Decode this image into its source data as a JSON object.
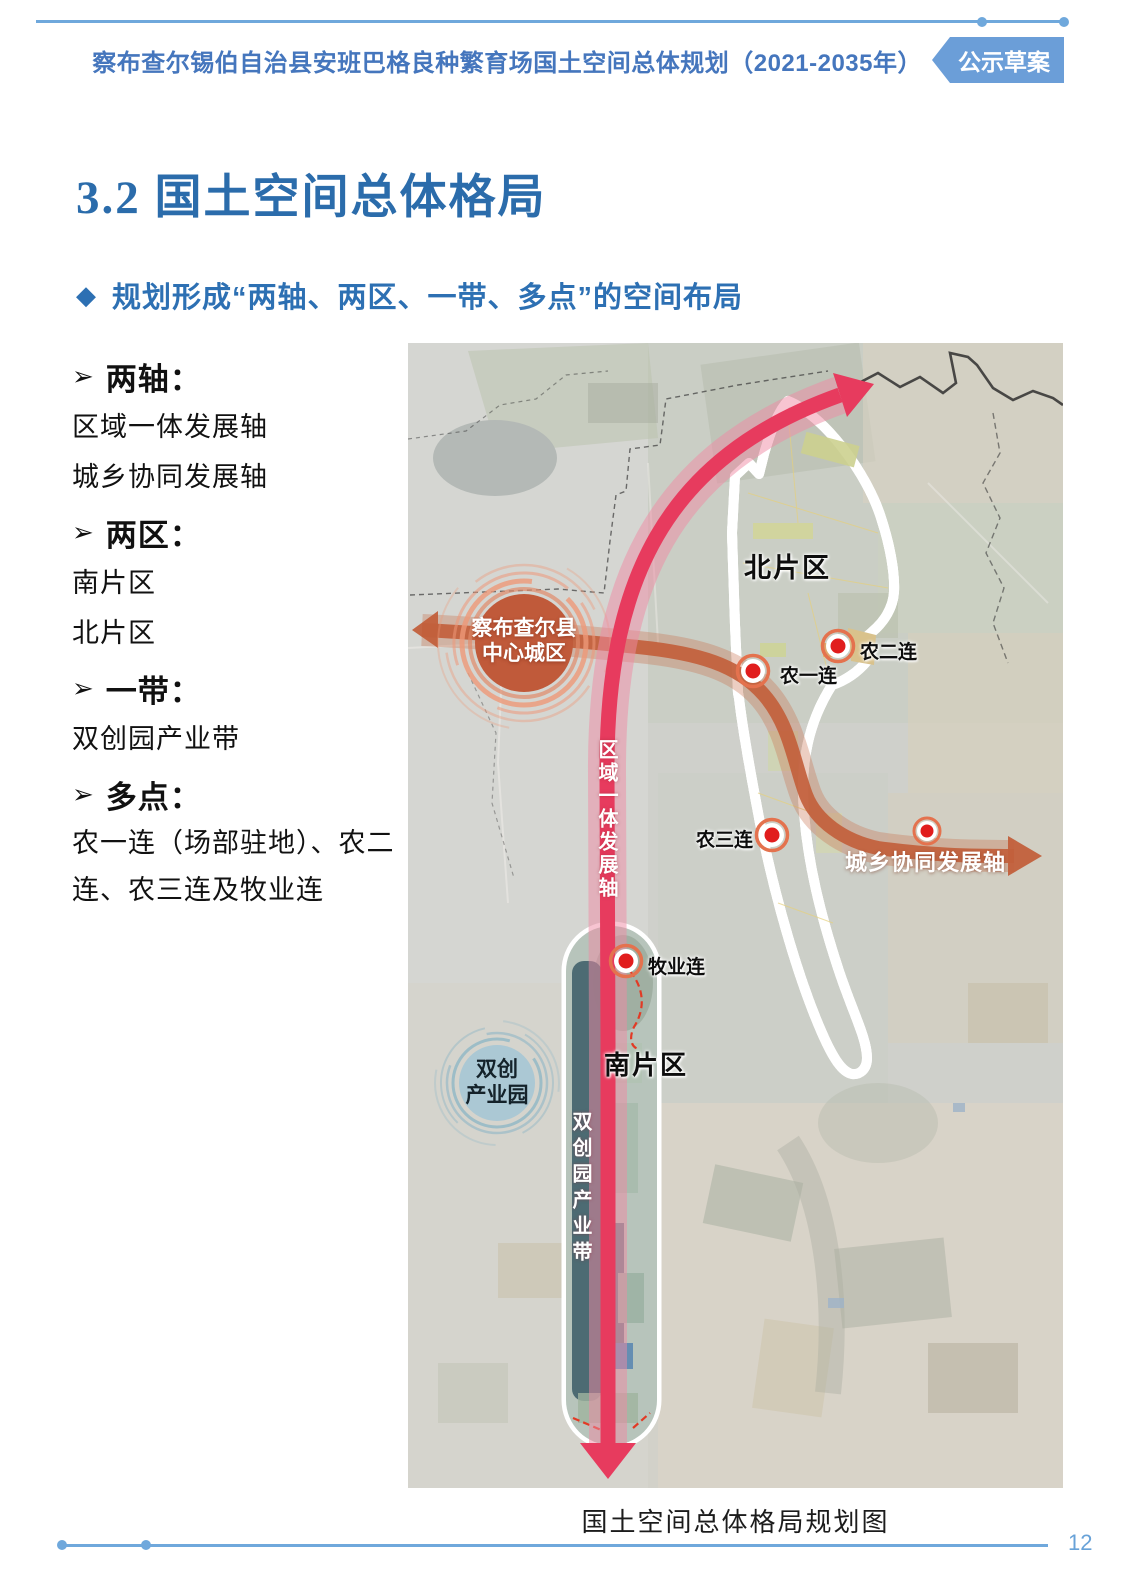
{
  "header": {
    "title": "察布查尔锡伯自治县安班巴格良种繁育场国土空间总体规划（2021-2035年）",
    "badge": "公示草案"
  },
  "section": {
    "title": "3.2 国土空间总体格局",
    "bullet": "◆",
    "subheading": "规划形成“两轴、两区、一带、多点”的空间布局"
  },
  "list": {
    "bullet": "➢",
    "groups": [
      {
        "label": "两轴：",
        "details": [
          "区域一体发展轴",
          "城乡协同发展轴"
        ]
      },
      {
        "label": "两区：",
        "details": [
          "南片区",
          "北片区"
        ]
      },
      {
        "label": "一带：",
        "details": [
          "双创园产业带"
        ]
      },
      {
        "label": "多点：",
        "details": [
          "农一连（场部驻地）、农二连、农三连及牧业连"
        ]
      }
    ]
  },
  "map": {
    "caption": "国土空间总体格局规划图",
    "zones": {
      "north": "北片区",
      "south": "南片区"
    },
    "axes": {
      "regional": "区域一体发展轴",
      "urban_rural": "城乡协同发展轴"
    },
    "nodes": {
      "nong1": "农一连",
      "nong2": "农二连",
      "nong3": "农三连",
      "muye": "牧业连"
    },
    "county_center": {
      "line1": "察布查尔县",
      "line2": "中心城区"
    },
    "industry_park": {
      "line1": "双创",
      "line2": "产业园"
    },
    "industry_belt": "双创园产业带"
  },
  "footer": {
    "page": "12"
  },
  "colors": {
    "accent_blue": "#6fa8dc",
    "header_title_blue": "#4576bd",
    "heading_blue": "#2b6cab",
    "badge_bg": "#6b9ed8",
    "axis_red": "#e73b5e",
    "axis_orange": "#c2603c",
    "zone_yellow": "#f7e191",
    "zone_border_red": "#e23a25",
    "county_circle": "#c05a3a",
    "park_circle": "#abc8d4",
    "belt_teal": "#47666f",
    "node_red": "#e11d1d"
  }
}
